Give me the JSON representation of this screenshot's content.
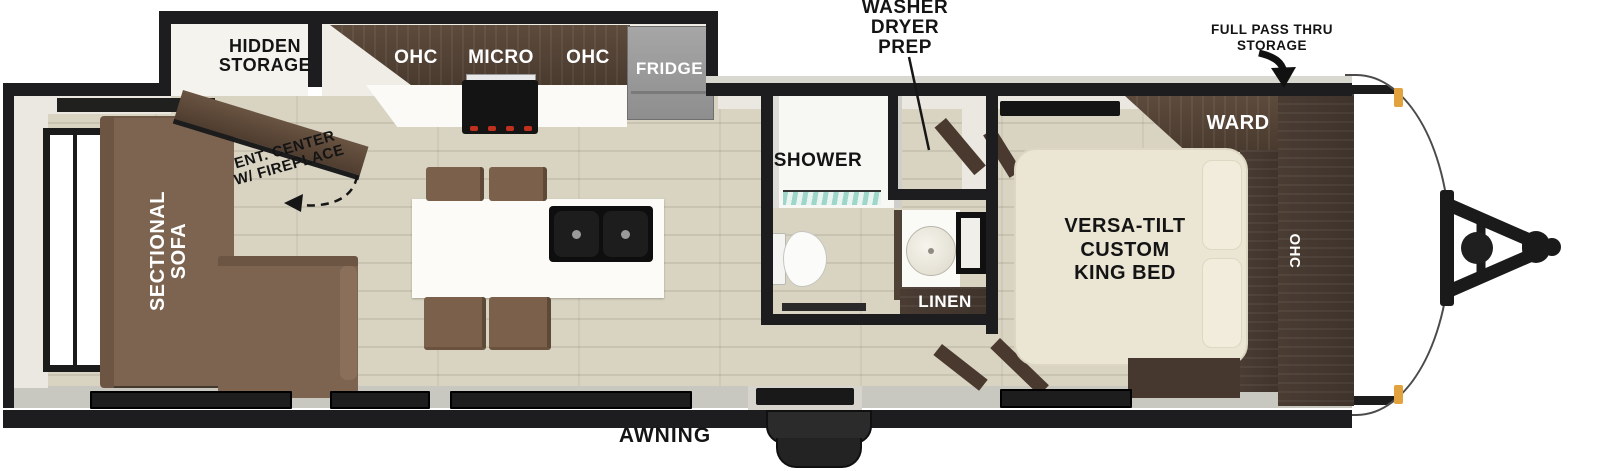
{
  "title": "Travel trailer floor plan",
  "labels": {
    "hidden_storage": "HIDDEN\nSTORAGE",
    "washer_dryer_prep": "WASHER\nDRYER\nPREP",
    "full_pass_thru_storage": "FULL PASS THRU\nSTORAGE",
    "ent_center": "ENT. CENTER\nW/ FIREPLACE",
    "sectional_sofa": "SECTIONAL\nSOFA",
    "ohc_left": "OHC",
    "micro": "MICRO",
    "ohc_right": "OHC",
    "fridge": "FRIDGE",
    "shower": "SHOWER",
    "linen": "LINEN",
    "ward": "WARD",
    "king_bed": "VERSA-TILT\nCUSTOM\nKING BED",
    "ohc_front": "OHC",
    "awning": "AWNING"
  },
  "colors": {
    "wall": "#1d1d1f",
    "floor": "#d9d4c2",
    "cabinet_wood": "#4e3f33",
    "sofa": "#7d6450",
    "stool": "#7b614b",
    "bed": "#ebe5d3",
    "fridge": "#9c9c9c",
    "marker_light": "#e2a23d",
    "shower_glass": "#8fd0c2",
    "label_text": "#141414",
    "label_text_on_wood": "#ffffff"
  }
}
